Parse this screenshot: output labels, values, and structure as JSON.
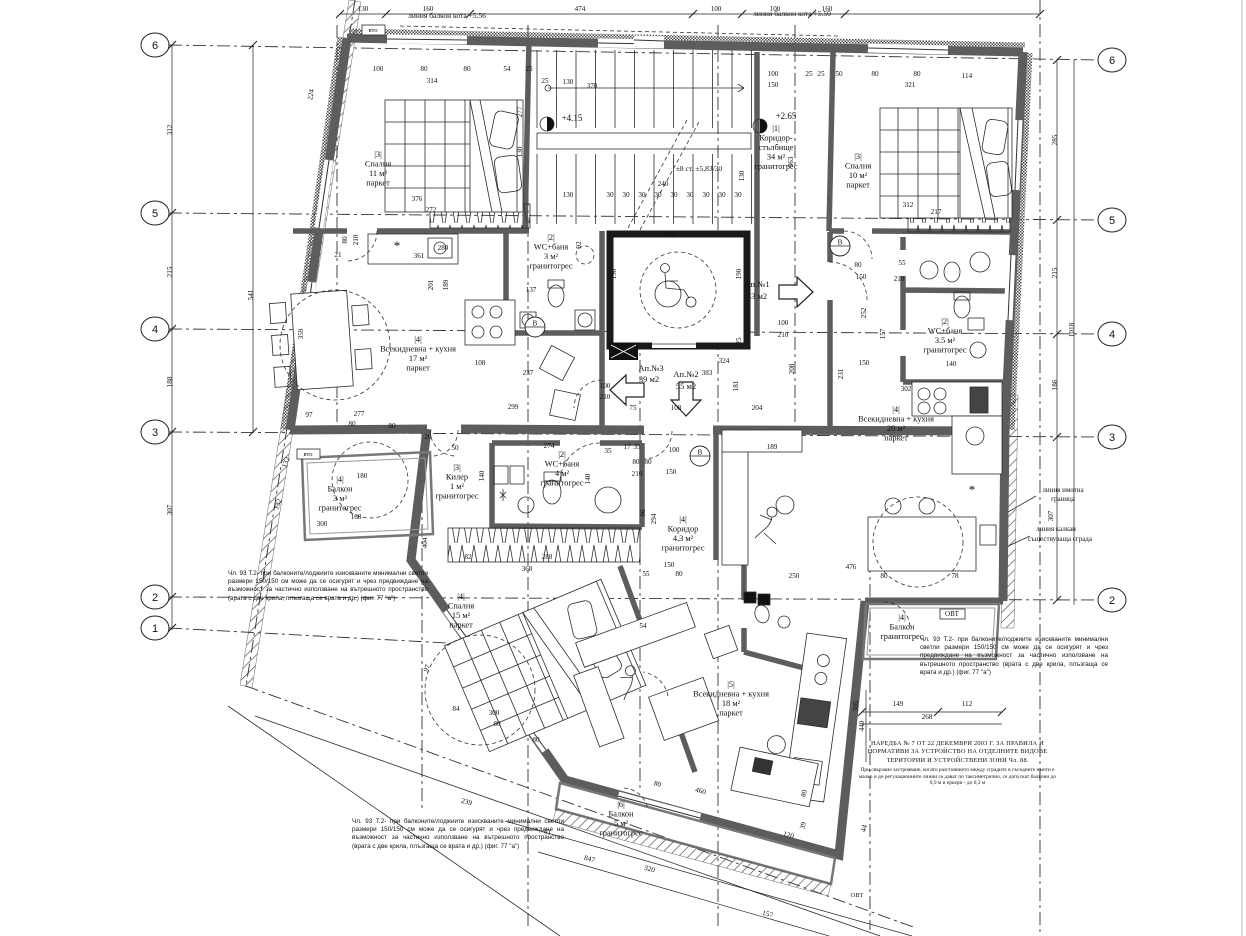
{
  "drawing": {
    "type": "architectural floor plan",
    "language": "Bulgarian"
  },
  "grid_bubbles": [
    {
      "x": 155,
      "y": 45,
      "t": "6"
    },
    {
      "x": 155,
      "y": 213,
      "t": "5"
    },
    {
      "x": 155,
      "y": 329,
      "t": "4"
    },
    {
      "x": 155,
      "y": 432,
      "t": "3"
    },
    {
      "x": 155,
      "y": 597,
      "t": "2"
    },
    {
      "x": 155,
      "y": 628,
      "t": "1"
    },
    {
      "x": 1112,
      "y": 60,
      "t": "6"
    },
    {
      "x": 1112,
      "y": 220,
      "t": "5"
    },
    {
      "x": 1112,
      "y": 334,
      "t": "4"
    },
    {
      "x": 1112,
      "y": 437,
      "t": "3"
    },
    {
      "x": 1112,
      "y": 600,
      "t": "2"
    }
  ],
  "rooms": [
    {
      "x": 378,
      "y": 157,
      "lines": [
        "|3|",
        "Спалня",
        "11 м²",
        "паркет"
      ]
    },
    {
      "x": 858,
      "y": 159,
      "lines": [
        "|3|",
        "Спалня",
        "10 м²",
        "паркет"
      ]
    },
    {
      "x": 551,
      "y": 240,
      "lines": [
        "|2|",
        "WC+баня",
        "3 м²",
        "гранитогрес"
      ]
    },
    {
      "x": 776,
      "y": 131,
      "lines": [
        "|1|",
        "Коридор-",
        "стълбище",
        "34 м²",
        "гранитогрес"
      ]
    },
    {
      "x": 418,
      "y": 342,
      "lines": [
        "|4|",
        "Всекидневна + кухня",
        "17 м²",
        "паркет"
      ]
    },
    {
      "x": 945,
      "y": 324,
      "lines": [
        "|2|",
        "WC+баня",
        "3.5 м²",
        "гранитогрес"
      ]
    },
    {
      "x": 896,
      "y": 412,
      "lines": [
        "|4|",
        "Всекидневна + кухня",
        "20 м²",
        "паркет"
      ]
    },
    {
      "x": 340,
      "y": 482,
      "lines": [
        "|4|",
        "Балкон",
        "3 м²",
        "гранитогрес"
      ]
    },
    {
      "x": 457,
      "y": 470,
      "lines": [
        "|3|",
        "Килер",
        "1 м²",
        "гранитогрес"
      ]
    },
    {
      "x": 562,
      "y": 457,
      "lines": [
        "|2|",
        "WC+баня",
        "4 м²",
        "гранитогрес"
      ]
    },
    {
      "x": 683,
      "y": 522,
      "lines": [
        "|4|",
        "Коридор",
        "4.3 м²",
        "гранитогрес"
      ]
    },
    {
      "x": 461,
      "y": 599,
      "lines": [
        "|4|",
        "Спалня",
        "15 м²",
        "паркет"
      ]
    },
    {
      "x": 731,
      "y": 687,
      "lines": [
        "|5|",
        "Всекидневна + кухня",
        "18 м²",
        "паркет"
      ]
    },
    {
      "x": 902,
      "y": 620,
      "lines": [
        "|4|",
        "Балкон",
        "гранитогрес"
      ]
    },
    {
      "x": 621,
      "y": 807,
      "lines": [
        "|6|",
        "Балкон",
        "5 м²",
        "гранитогрес"
      ]
    }
  ],
  "texts": [
    [
      447,
      18,
      "линия балкон кота +5.56",
      0,
      7.5
    ],
    [
      792,
      16,
      "линия балкон кота +5.50",
      0,
      7.5
    ],
    [
      373,
      32,
      "вто",
      0,
      6.5
    ],
    [
      308,
      456,
      "вто",
      0,
      6.5
    ],
    [
      952,
      616,
      "ОВТ",
      0,
      7
    ],
    [
      857,
      897,
      "ОВТ",
      0,
      6.5
    ],
    [
      572,
      121,
      "+4.15",
      0,
      9
    ],
    [
      786,
      119,
      "+2.65",
      0,
      9
    ],
    [
      699,
      171,
      "±8 ст. ±5,83/30",
      0,
      7.5
    ],
    [
      757,
      287,
      "Ап.№1",
      0,
      8.5
    ],
    [
      757,
      299,
      "43 м2",
      0,
      8.5
    ],
    [
      686,
      377,
      "Ап.№2",
      0,
      8.5
    ],
    [
      686,
      389,
      "55 м2",
      0,
      8.5
    ],
    [
      651,
      371,
      "Ап.№3",
      0,
      8.5
    ],
    [
      649,
      382,
      "39 м2",
      0,
      8.5
    ],
    [
      1063,
      492,
      "линия имотна",
      0,
      7
    ],
    [
      1063,
      501,
      "граница",
      0,
      7
    ],
    [
      1056,
      531,
      "линия калкан",
      0,
      7
    ],
    [
      1060,
      541,
      "съществуваща сграда",
      0,
      7
    ],
    [
      972,
      494,
      "*",
      0,
      13
    ],
    [
      397,
      250,
      "*",
      0,
      13
    ]
  ],
  "badges": [
    [
      840,
      246,
      "В"
    ],
    [
      535,
      327,
      "В"
    ],
    [
      700,
      456,
      "В"
    ]
  ],
  "dims": [
    [
      363,
      11,
      "130"
    ],
    [
      428,
      11,
      "160"
    ],
    [
      580,
      11,
      "474"
    ],
    [
      716,
      11,
      "100"
    ],
    [
      775,
      11,
      "100"
    ],
    [
      827,
      11,
      "160"
    ],
    [
      172,
      130,
      "312",
      -90
    ],
    [
      172,
      272,
      "215",
      -90
    ],
    [
      172,
      382,
      "188",
      -90
    ],
    [
      172,
      510,
      "307",
      -90
    ],
    [
      253,
      295,
      "541",
      -90
    ],
    [
      313,
      95,
      "224",
      -80
    ],
    [
      1057,
      140,
      "285",
      -90
    ],
    [
      1057,
      273,
      "215",
      -90
    ],
    [
      1057,
      385,
      "186",
      -90
    ],
    [
      1074,
      330,
      "1018",
      -90
    ],
    [
      1053,
      516,
      "307",
      -90
    ],
    [
      378,
      71,
      "100"
    ],
    [
      424,
      71,
      "80"
    ],
    [
      467,
      71,
      "80"
    ],
    [
      432,
      83,
      "314"
    ],
    [
      507,
      71,
      "54"
    ],
    [
      529,
      71,
      "25"
    ],
    [
      545,
      83,
      "25"
    ],
    [
      568,
      84,
      "130"
    ],
    [
      592,
      88,
      "370"
    ],
    [
      417,
      201,
      "376"
    ],
    [
      431,
      212,
      "272"
    ],
    [
      347,
      240,
      "80",
      -90
    ],
    [
      358,
      240,
      "210",
      -90
    ],
    [
      338,
      257,
      "21"
    ],
    [
      419,
      258,
      "361"
    ],
    [
      443,
      250,
      "280"
    ],
    [
      433,
      285,
      "201",
      -90
    ],
    [
      448,
      285,
      "189",
      -90
    ],
    [
      581,
      245,
      "92",
      -90
    ],
    [
      531,
      292,
      "137"
    ],
    [
      522,
      112,
      "277",
      -90
    ],
    [
      522,
      152,
      "130",
      -90
    ],
    [
      568,
      197,
      "130"
    ],
    [
      610,
      197,
      "30"
    ],
    [
      626,
      197,
      "30"
    ],
    [
      642,
      197,
      "30"
    ],
    [
      658,
      197,
      "30"
    ],
    [
      674,
      197,
      "30"
    ],
    [
      690,
      197,
      "30"
    ],
    [
      706,
      197,
      "30"
    ],
    [
      722,
      197,
      "30"
    ],
    [
      738,
      197,
      "30"
    ],
    [
      663,
      186,
      "240"
    ],
    [
      744,
      176,
      "130",
      -90
    ],
    [
      671,
      237,
      "233"
    ],
    [
      616,
      274,
      "190",
      -90
    ],
    [
      741,
      274,
      "190",
      -90
    ],
    [
      793,
      162,
      "363",
      -90
    ],
    [
      773,
      76,
      "100"
    ],
    [
      773,
      87,
      "150"
    ],
    [
      809,
      76,
      "25"
    ],
    [
      821,
      76,
      "25"
    ],
    [
      839,
      76,
      "50"
    ],
    [
      875,
      76,
      "80"
    ],
    [
      917,
      76,
      "80"
    ],
    [
      967,
      78,
      "114"
    ],
    [
      910,
      87,
      "321"
    ],
    [
      908,
      207,
      "312"
    ],
    [
      936,
      214,
      "217"
    ],
    [
      858,
      267,
      "80"
    ],
    [
      861,
      279,
      "150"
    ],
    [
      902,
      265,
      "55"
    ],
    [
      899,
      281,
      "210"
    ],
    [
      866,
      313,
      "252",
      -90
    ],
    [
      885,
      334,
      "157",
      -90
    ],
    [
      843,
      374,
      "231",
      -90
    ],
    [
      864,
      365,
      "150"
    ],
    [
      906,
      391,
      "302"
    ],
    [
      951,
      366,
      "140"
    ],
    [
      724,
      363,
      "324"
    ],
    [
      707,
      375,
      "383"
    ],
    [
      738,
      386,
      "181",
      -90
    ],
    [
      794,
      369,
      "208",
      -90
    ],
    [
      757,
      410,
      "204"
    ],
    [
      676,
      410,
      "108"
    ],
    [
      633,
      410,
      "75"
    ],
    [
      741,
      341,
      "25",
      -90
    ],
    [
      783,
      325,
      "100"
    ],
    [
      783,
      337,
      "210"
    ],
    [
      605,
      388,
      "100"
    ],
    [
      605,
      399,
      "210"
    ],
    [
      772,
      449,
      "189"
    ],
    [
      637,
      449,
      "35"
    ],
    [
      627,
      449,
      "17"
    ],
    [
      480,
      365,
      "108"
    ],
    [
      528,
      375,
      "237"
    ],
    [
      513,
      409,
      "299"
    ],
    [
      359,
      416,
      "277"
    ],
    [
      309,
      417,
      "97"
    ],
    [
      303,
      334,
      "359",
      -90
    ],
    [
      428,
      439,
      "20"
    ],
    [
      549,
      448,
      "274"
    ],
    [
      608,
      453,
      "35"
    ],
    [
      674,
      452,
      "100"
    ],
    [
      636,
      464,
      "80"
    ],
    [
      648,
      464,
      "80"
    ],
    [
      637,
      476,
      "210"
    ],
    [
      671,
      474,
      "150"
    ],
    [
      484,
      476,
      "140",
      -90
    ],
    [
      590,
      479,
      "140",
      -90
    ],
    [
      468,
      559,
      "82"
    ],
    [
      547,
      559,
      "288"
    ],
    [
      527,
      571,
      "368"
    ],
    [
      645,
      513,
      "86",
      -90
    ],
    [
      656,
      519,
      "294",
      -90
    ],
    [
      646,
      576,
      "55"
    ],
    [
      679,
      576,
      "80"
    ],
    [
      669,
      567,
      "150"
    ],
    [
      427,
      543,
      "404",
      -90
    ],
    [
      455,
      450,
      "50"
    ],
    [
      352,
      426,
      "80"
    ],
    [
      392,
      428,
      "80"
    ],
    [
      362,
      478,
      "180"
    ],
    [
      356,
      519,
      "168"
    ],
    [
      322,
      526,
      "300"
    ],
    [
      288,
      463,
      "132",
      -70
    ],
    [
      280,
      505,
      "132",
      -70
    ],
    [
      643,
      628,
      "54"
    ],
    [
      456,
      711,
      "84"
    ],
    [
      494,
      715,
      "300"
    ],
    [
      497,
      726,
      "80"
    ],
    [
      536,
      742,
      "80"
    ],
    [
      466,
      804,
      "239",
      15
    ],
    [
      429,
      669,
      "97",
      -70
    ],
    [
      547,
      834,
      "81",
      15
    ],
    [
      589,
      861,
      "847",
      15
    ],
    [
      649,
      871,
      "320",
      15
    ],
    [
      767,
      916,
      "157",
      15
    ],
    [
      657,
      786,
      "80",
      15
    ],
    [
      700,
      793,
      "460",
      15
    ],
    [
      806,
      794,
      "80",
      -75
    ],
    [
      788,
      837,
      "120",
      15
    ],
    [
      805,
      826,
      "39",
      -75
    ],
    [
      858,
      706,
      "305",
      -90
    ],
    [
      864,
      726,
      "440",
      -90
    ],
    [
      866,
      829,
      "44",
      -75
    ],
    [
      898,
      706,
      "149"
    ],
    [
      967,
      706,
      "112"
    ],
    [
      927,
      719,
      "268"
    ],
    [
      794,
      578,
      "250"
    ],
    [
      851,
      569,
      "476"
    ],
    [
      884,
      578,
      "80"
    ],
    [
      955,
      578,
      "78"
    ]
  ],
  "notes": {
    "balcony_rule": "Чл. 93 Т.2- при балконите/лоджиите изискваните минимални светли размери 150/150 см може да се осигурят и чрез предвиждане на възможност за частично използване на вътрешното пространство (врата с две крила, плъзгаща се врата и др.) (фиг. 77 \"а\")",
    "naredba_title": "НАРЕДБА № 7 ОТ 22 ДЕКЕМВРИ 2003 Г. ЗА ПРАВИЛА И НОРМАТИВИ ЗА УСТРОЙСТВО НА ОТДЕЛНИТЕ ВИДОВЕ ТЕРИТОРИИ И УСТРОЙСТВЕНИ ЗОНИ Чл. 88.",
    "naredba_body": "При свързано застрояване, когато разстоянието между сградите в съседните имоти е малко и до регулационните линии се дават по таксиметрично, се допускат балкони до 0,9 м и еркери - до 0,3 м"
  }
}
